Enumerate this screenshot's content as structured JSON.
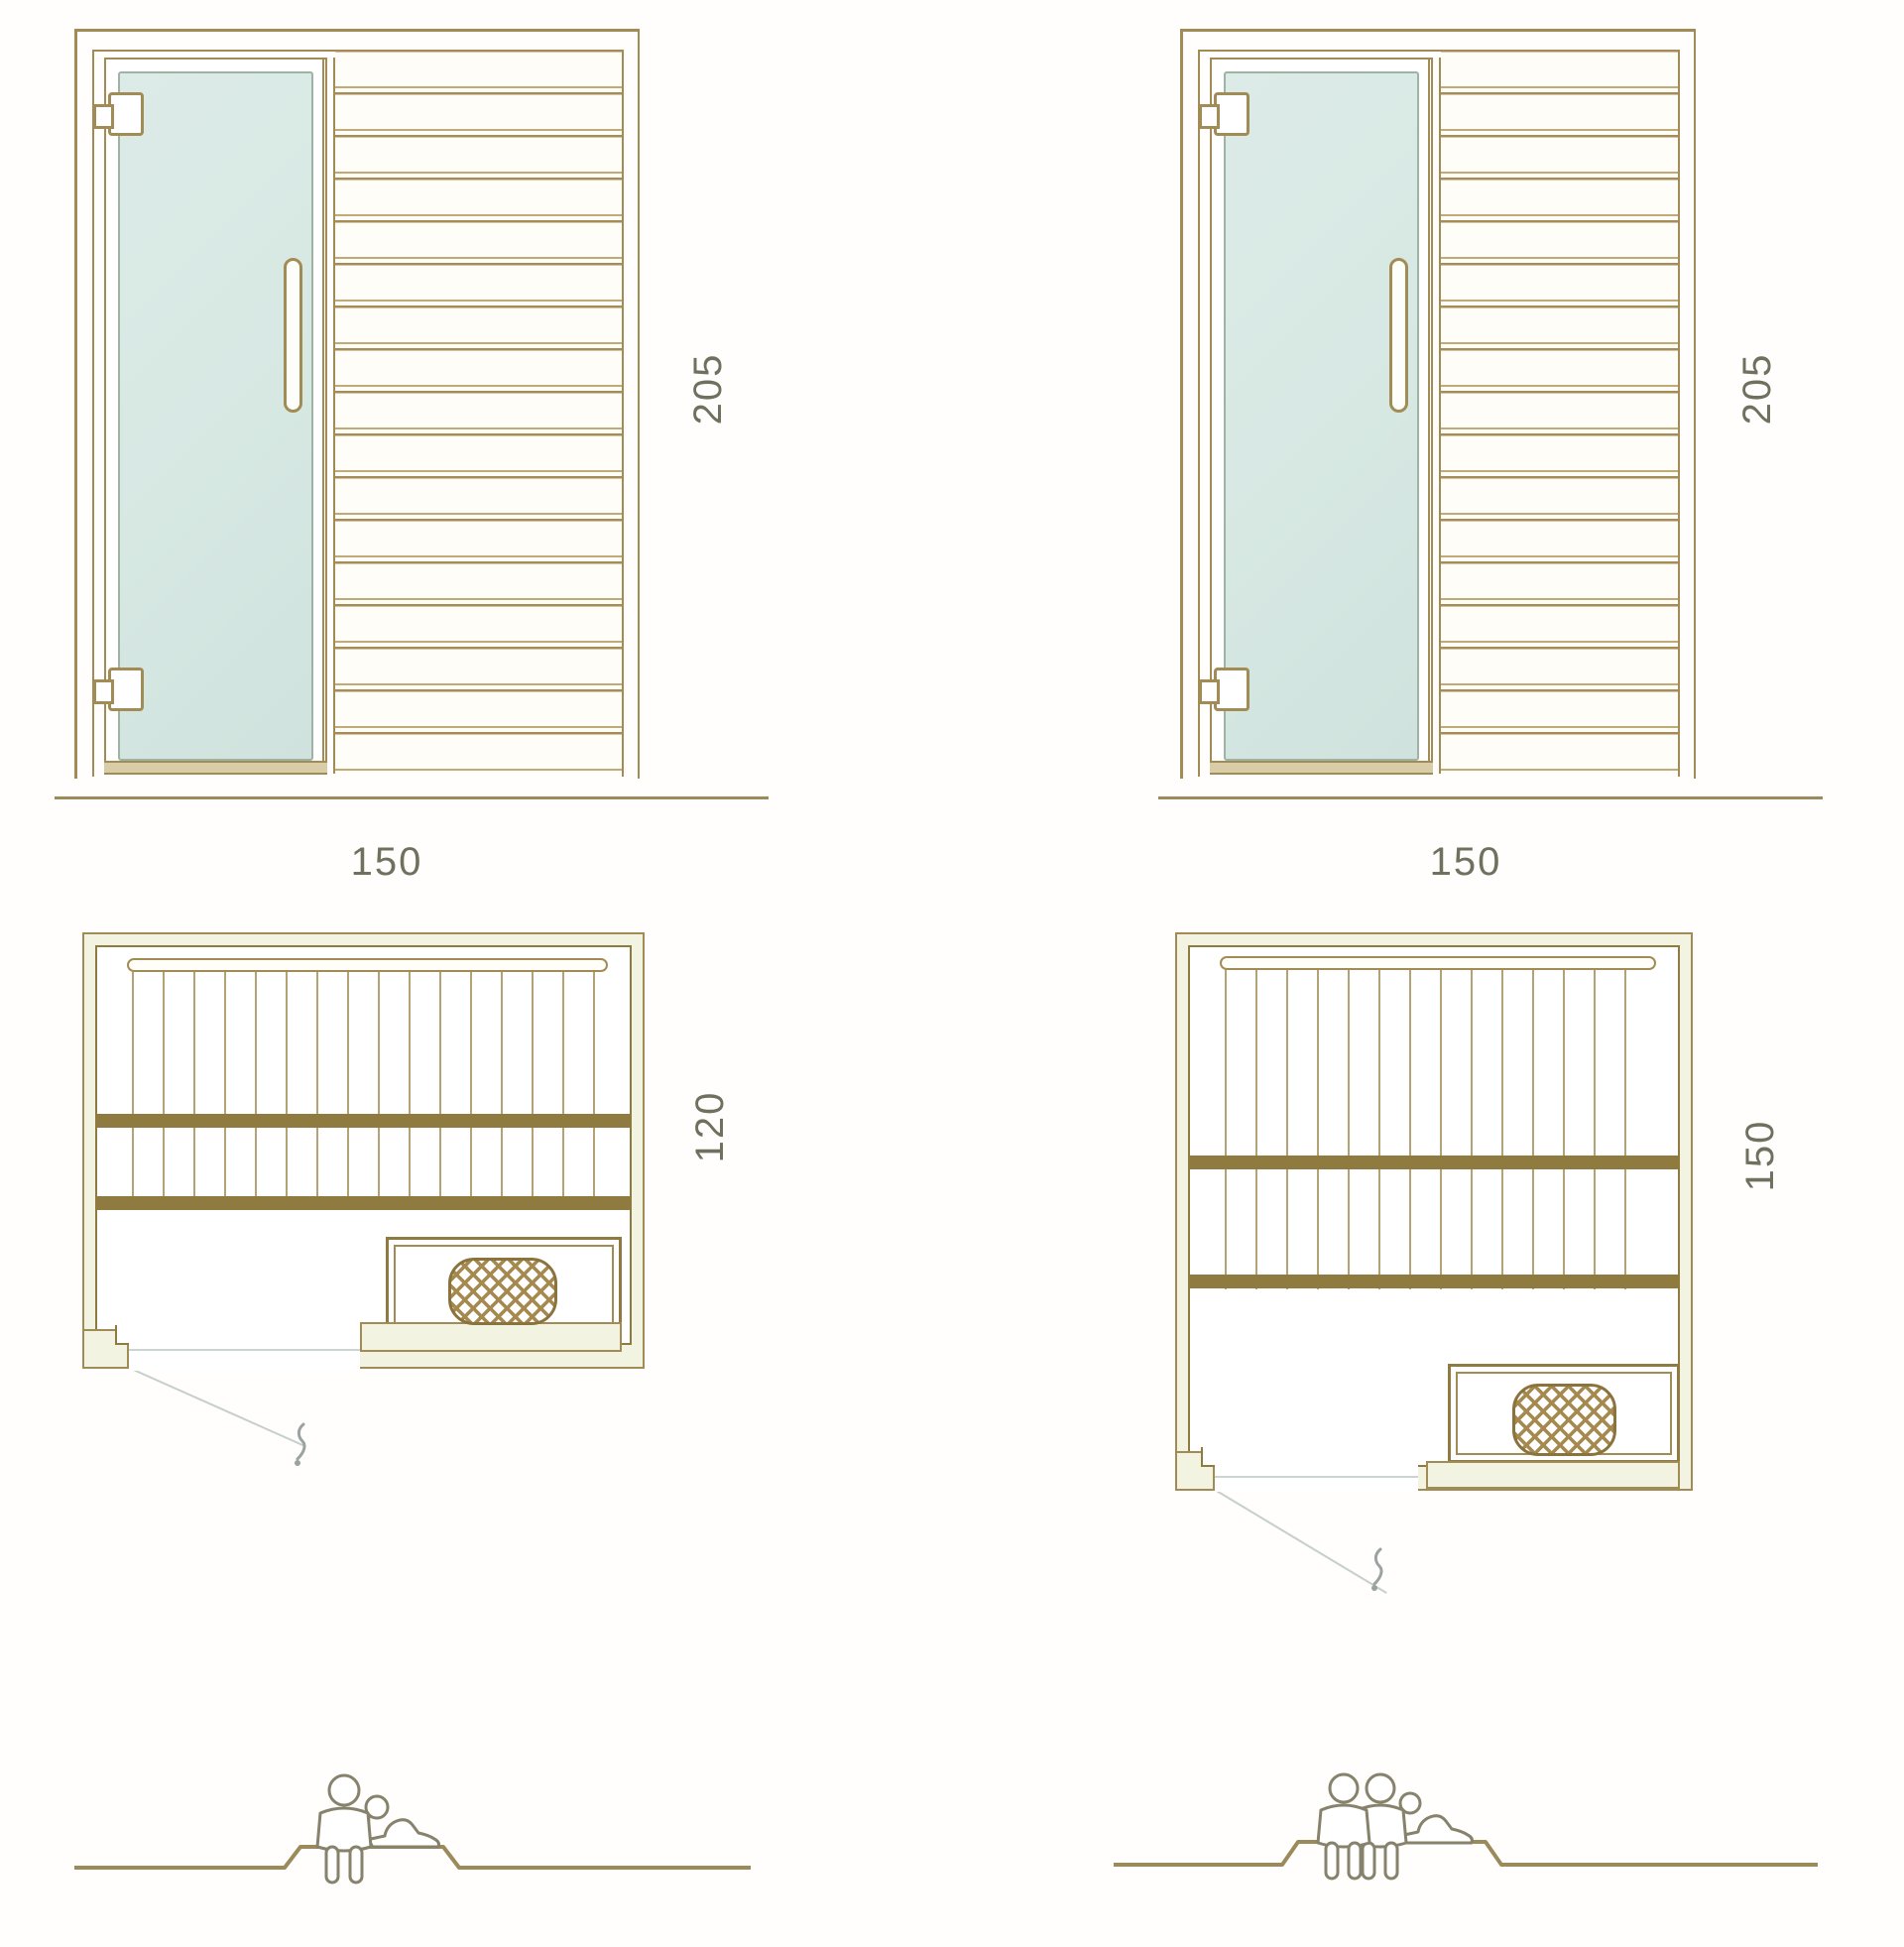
{
  "title": "sauna-cabin-technical-drawing",
  "models": {
    "left": {
      "front_view": {
        "width_label": "150",
        "height_label": "205"
      },
      "plan_view": {
        "depth_label": "120"
      },
      "capacity": {
        "icon": "two-person-bench",
        "seated": 1,
        "reclining": 1
      }
    },
    "right": {
      "front_view": {
        "width_label": "150",
        "height_label": "205"
      },
      "plan_view": {
        "depth_label": "150"
      },
      "capacity": {
        "icon": "three-person-bench",
        "seated": 2,
        "reclining": 1
      }
    }
  },
  "icons": [
    "glass-door",
    "door-hinge",
    "door-handle",
    "wood-slat-panel",
    "bench-slats",
    "heater-stove",
    "door-swing-line",
    "door-swing-handle-glyph",
    "capacity-people-icon",
    "ground-line"
  ],
  "colors": {
    "line_olive": "#a28c55",
    "line_dark": "#8f7a3f",
    "glass": "#d9e9e6",
    "wall_fill": "#f2f3e1",
    "dimension_text": "#70705e",
    "swing_line": "#c6cfcb",
    "figure_outline": "#87826b",
    "ground_line": "#9b8a5a"
  }
}
